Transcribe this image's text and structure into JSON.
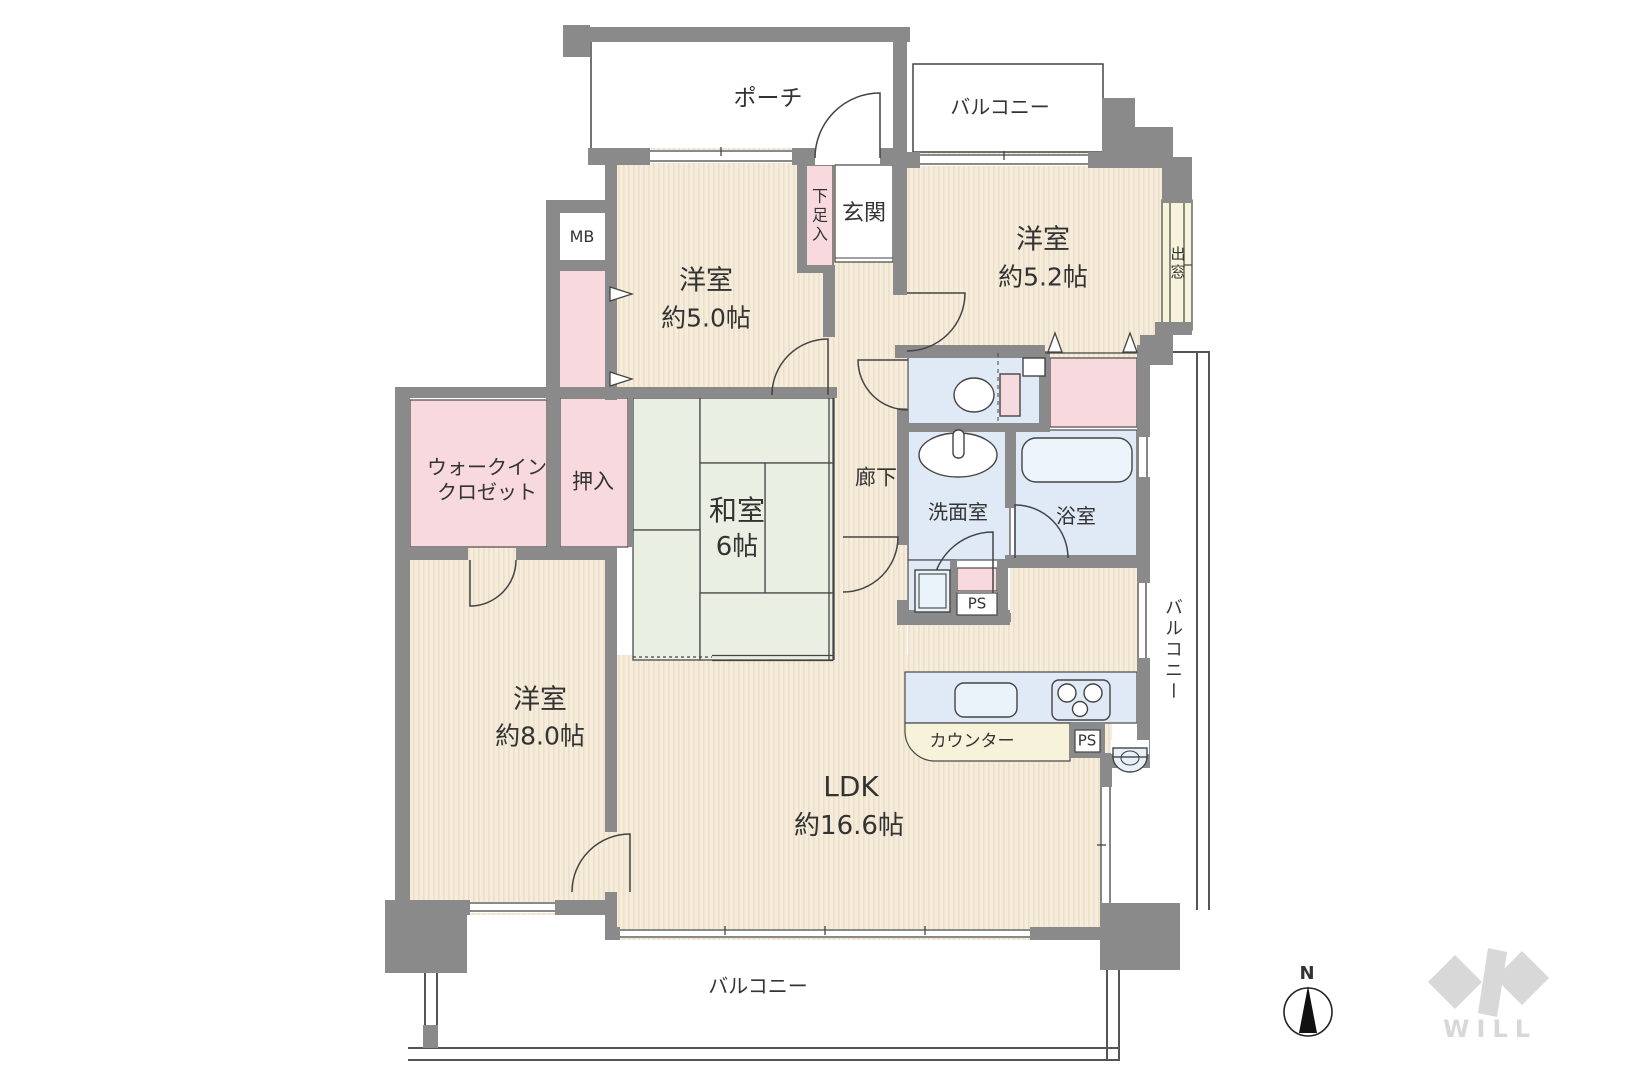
{
  "plan": {
    "rooms": {
      "porch": {
        "label": "ポーチ"
      },
      "balcony_top": {
        "label": "バルコニー"
      },
      "genkan": {
        "label": "玄関"
      },
      "shoebox": {
        "label": "下足入"
      },
      "meter_box": {
        "label": "MB"
      },
      "western_room_5_0": {
        "label": "洋室",
        "size": "約5.0帖"
      },
      "western_room_5_2": {
        "label": "洋室",
        "size": "約5.2帖"
      },
      "bay_window": {
        "label": "出窓"
      },
      "walk_in_closet": {
        "line1": "ウォークイン",
        "line2": "クロゼット"
      },
      "oshiire": {
        "label": "押入"
      },
      "japanese_room": {
        "label": "和室",
        "size": "6帖"
      },
      "hallway": {
        "label": "廊下"
      },
      "washroom": {
        "label": "洗面室"
      },
      "bathroom": {
        "label": "浴室"
      },
      "pipe_space_bath": {
        "label": "PS"
      },
      "western_room_8_0": {
        "label": "洋室",
        "size": "約8.0帖"
      },
      "ldk": {
        "label": "LDK",
        "size": "約16.6帖"
      },
      "kitchen_counter": {
        "label": "カウンター"
      },
      "pipe_space_kitchen": {
        "label": "PS"
      },
      "balcony_right": {
        "label": "バルコニー"
      },
      "balcony_bottom": {
        "label": "バルコニー"
      }
    },
    "compass": {
      "north_label": "N"
    },
    "brand": {
      "logo_text": "WILL"
    },
    "colors": {
      "wall": "#8a8a8a",
      "room_floor": "#f5ecdb",
      "room_floor_stripe": "#ece0c8",
      "tatami": "#e9f0e3",
      "closet_pink": "#f8d9de",
      "wet_area_blue": "#dfeaf6",
      "counter_cream": "#f7f3da",
      "line": "#444444",
      "logo_gray": "#d8d8d8"
    }
  }
}
